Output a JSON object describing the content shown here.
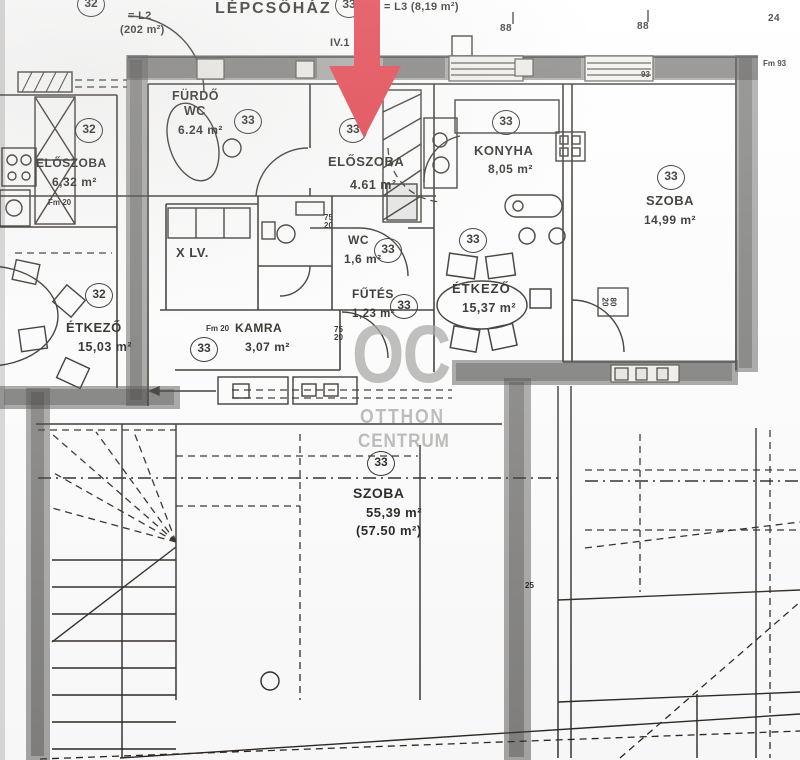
{
  "header": {
    "staircase_label": "LÉPCSŐHÁZ",
    "left_unit_circle": "32",
    "left_unit_eq": "= L2",
    "left_unit_area": "(202 m²)",
    "mid_unit_circle": "33",
    "mid_unit_eq": "= L3 (8,19 m²)",
    "level_note": "IV.1"
  },
  "watermark": {
    "initials": "OC",
    "name_line1": "OTTHON",
    "name_line2": "CENTRUM"
  },
  "rooms": {
    "eloszoba32": {
      "name": "ELŐSZOBA",
      "area": "6,32 m²",
      "unit": "32"
    },
    "furdo": {
      "name": "FÜRDŐ",
      "name2": "WC",
      "area": "6.24 m²",
      "unit": "33"
    },
    "eloszoba33": {
      "name": "ELŐSZOBA",
      "area": "4.61 m²",
      "unit": "33"
    },
    "konyha": {
      "name": "KONYHA",
      "area": "8,05 m²",
      "unit": "33"
    },
    "szoba_right": {
      "name": "SZOBA",
      "area": "14,99 m²",
      "unit": "33"
    },
    "wc": {
      "name": "WC",
      "area": "1,6 m²",
      "unit": "33"
    },
    "futes": {
      "name": "FŰTÉS",
      "area": "1,23 m²",
      "unit": "33"
    },
    "etkezo33": {
      "name": "ÉTKEZŐ",
      "area": "15,37 m²",
      "unit": "33"
    },
    "etkezo32": {
      "name": "ÉTKEZŐ",
      "area": "15,03 m²",
      "unit": "32"
    },
    "kamra": {
      "name": "KAMRA",
      "area": "3,07 m²",
      "unit": "33",
      "dim_note": "Fm 20"
    },
    "szoba_attic": {
      "name": "SZOBA",
      "area": "55,39 m²",
      "area_alt": "(57.50 m²)",
      "unit": "33"
    },
    "lv": {
      "name": "X LV."
    }
  },
  "dims": {
    "top_a": "88",
    "top_b": "88",
    "top_c": "24",
    "wall_a": "93",
    "wall_b": "Fm 93",
    "attic": "25",
    "door_a1": "75",
    "door_a2": "20",
    "door_b1": "75",
    "door_b2": "20",
    "rad1": "80",
    "rad2": "20",
    "left_note": "Fm 20"
  }
}
